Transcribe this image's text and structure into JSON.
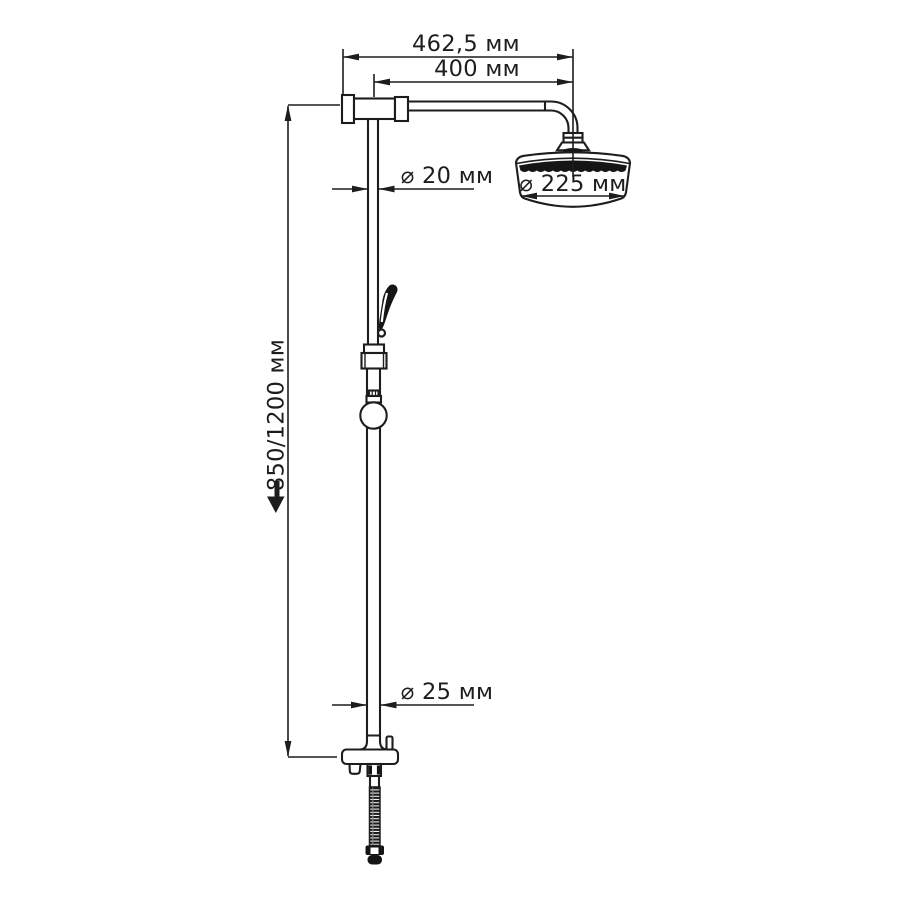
{
  "document": {
    "type": "technical-drawing",
    "subject": "shower column with overhead shower, hand shower, wall bracket and flexible hose",
    "background": "#ffffff",
    "ink": "#1d1d1d"
  },
  "dimensions": {
    "arm_overall": "462,5 мм",
    "arm_projection": "400 мм",
    "upper_pipe_diameter": "⌀ 20 мм",
    "head_diameter": "⌀ 225 мм",
    "column_height": "850/1200 мм",
    "lower_pipe_diameter": "⌀ 25 мм"
  }
}
